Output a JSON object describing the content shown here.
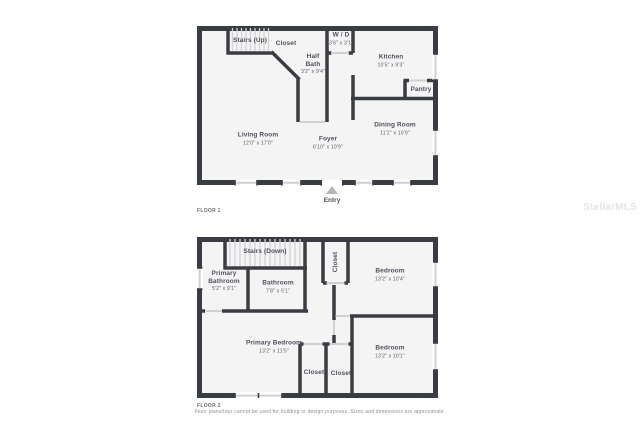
{
  "page": {
    "background": "#ffffff",
    "watermark": "StellarMLS",
    "disclaimer": "Floor plans/tour cannot be used for building or design purposes. Sizes and dimensions are approximate.",
    "colors": {
      "wall": "#393c42",
      "room_fill": "#f4f4f5",
      "window": "#ced0d3",
      "stair_tread": "#d2d3d5",
      "label_text": "#4d525b",
      "entry_arrow": "#b4b5b8"
    }
  },
  "floor1": {
    "label": "FLOOR 1",
    "entry": "Entry",
    "rooms": {
      "stairs_up": {
        "name": "Stairs (Up)",
        "dims": ""
      },
      "closet": {
        "name": "Closet",
        "dims": ""
      },
      "wd": {
        "name": "W / D",
        "dims": "3'6\" x 3'1\""
      },
      "half_bath": {
        "name": "Half Bath",
        "dims": "3'2\" x 9'4\""
      },
      "kitchen": {
        "name": "Kitchen",
        "dims": "10'5\" x 9'3\""
      },
      "pantry": {
        "name": "Pantry",
        "dims": ""
      },
      "living_room": {
        "name": "Living Room",
        "dims": "12'0\" x 17'0\""
      },
      "foyer": {
        "name": "Foyer",
        "dims": "6'10\" x 10'9\""
      },
      "dining_room": {
        "name": "Dining Room",
        "dims": "11'2\" x 10'9\""
      }
    }
  },
  "floor2": {
    "label": "FLOOR 2",
    "rooms": {
      "stairs_down": {
        "name": "Stairs (Down)",
        "dims": ""
      },
      "primary_bathroom": {
        "name": "Primary Bathroom",
        "dims": "5'2\" x 9'1\""
      },
      "bathroom": {
        "name": "Bathroom",
        "dims": "7'8\" x 5'1\""
      },
      "closet_hall": {
        "name": "Closet",
        "dims": ""
      },
      "bedroom_top": {
        "name": "Bedroom",
        "dims": "13'2\" x 10'4\""
      },
      "primary_bedroom": {
        "name": "Primary Bedroom",
        "dims": "13'2\" x 11'5\""
      },
      "closet_left": {
        "name": "Closet",
        "dims": ""
      },
      "closet_right": {
        "name": "Closet",
        "dims": ""
      },
      "bedroom_bottom": {
        "name": "Bedroom",
        "dims": "13'2\" x 10'1\""
      }
    }
  }
}
